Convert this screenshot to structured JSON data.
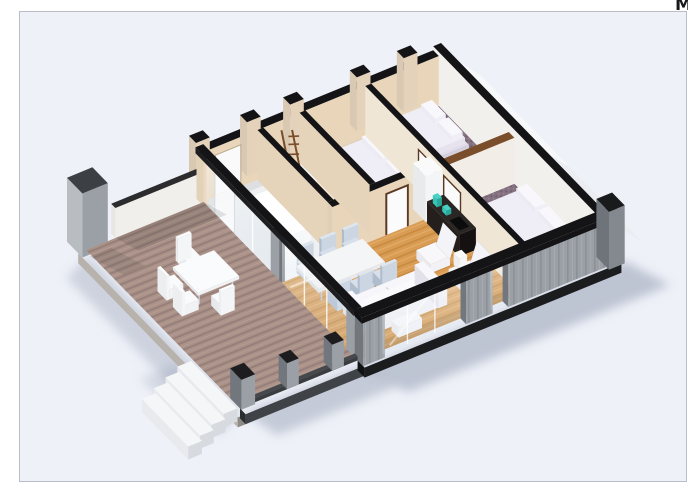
{
  "page": {
    "corner_glyph": "M"
  },
  "scene": {
    "type": "isometric-3d-floor-plan-render",
    "rooms": [
      {
        "id": "terrace",
        "label": "terrace-deck"
      },
      {
        "id": "entry-hall",
        "label": "entry-hall"
      },
      {
        "id": "bathroom",
        "label": "bathroom"
      },
      {
        "id": "bedroom-center",
        "label": "bedroom-center"
      },
      {
        "id": "bedroom-top-right",
        "label": "bedroom-top-right"
      },
      {
        "id": "bedroom-right",
        "label": "bedroom-right"
      },
      {
        "id": "living-dining",
        "label": "living-dining-room"
      },
      {
        "id": "kitchen",
        "label": "kitchen"
      }
    ],
    "furniture": [
      "double-bed x3",
      "sofa",
      "armchair x2",
      "dining-table",
      "dining-chair x6",
      "outdoor-table",
      "outdoor-chair x4",
      "kitchen-counter",
      "wardrobe",
      "toilet",
      "basin",
      "wooden-ladder",
      "exterior-stairs"
    ]
  },
  "palette": {
    "page_bg": "#ffffff",
    "canvas_bg": "#eef1f8",
    "frame_border": "#b9bdc5",
    "glyph_color": "#17181a",
    "wall_top": "#141416",
    "cap_wood": "#7a4e2a",
    "wall_cream": "#e9d6ba",
    "wall_cream_dark": "#d9c5a6",
    "wall_white": "#f2f0ec",
    "concrete": "#9aa0a6",
    "concrete_dark": "#71777d",
    "concrete_light": "#b8bdc2",
    "slab": "#1a1c1e",
    "deck_a": "#aa9289",
    "deck_b": "#97807a",
    "deck_c": "#b59c92",
    "oak_a": "#d99c54",
    "oak_b": "#c78a3e",
    "oak_c": "#e3ad68",
    "carpet_a": "#847180",
    "carpet_b": "#6d5b69",
    "carpet_c": "#9a8595",
    "cream_floor": "#f3e2c8",
    "lobby_floor": "#eedcbc",
    "hall_floor": "#eef0f2",
    "bath_floor": "#f6e8d2",
    "bed_base": "#d4d0de",
    "bed_side": "#e0dce9",
    "bed_top": "#efedf5",
    "pillow": "#f8f7fb",
    "sofa": "#f4f4f8",
    "sofa_shade": "#e3e2ea",
    "chair": "#ccd6e2",
    "chair_dark": "#aebccd",
    "glass_lo": "#c9d8e6",
    "teal": "#35c4b5",
    "kitch_top": "#2a2624",
    "kitch_face": "#241f1d",
    "kitch_side": "#141110",
    "stair_top": "#f5f6f8",
    "stair_face": "#d7dadf",
    "stair_side": "#e8eaed",
    "shadow": "#76809a",
    "white": "#ffffff"
  }
}
